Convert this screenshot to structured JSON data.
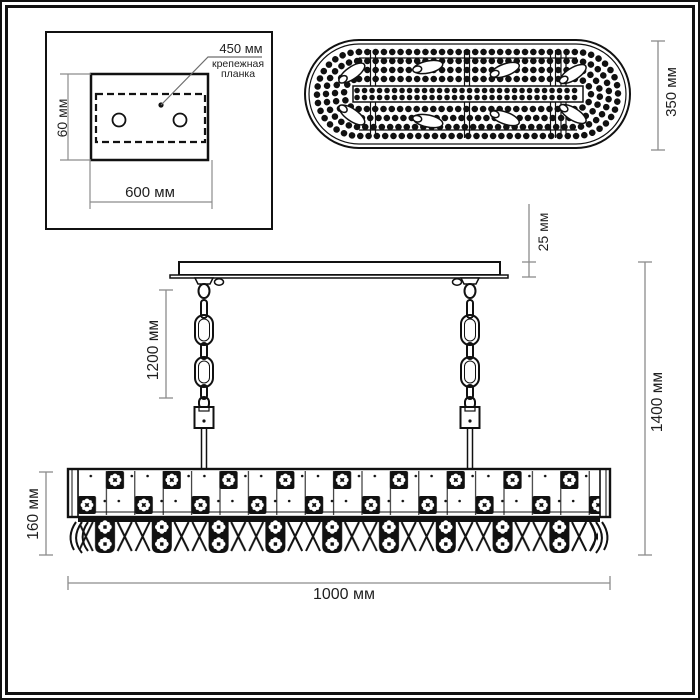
{
  "views": {
    "mounting_plate": {
      "hole_spacing": "450 мм",
      "bracket_label_line1": "крепежная",
      "bracket_label_line2": "планка",
      "plate_height": "60 мм",
      "plate_width": "600 мм"
    },
    "top_view": {
      "depth": "350 мм"
    },
    "front_view": {
      "canopy_thickness": "25 мм",
      "chain_length": "1200 мм",
      "overall_height": "1400 мм",
      "body_height": "160 мм",
      "overall_width": "1000 мм"
    }
  },
  "colors": {
    "ink": "#111111",
    "dimension_line": "#8c8c8c",
    "text": "#1f1f1f",
    "background": "#ffffff"
  }
}
